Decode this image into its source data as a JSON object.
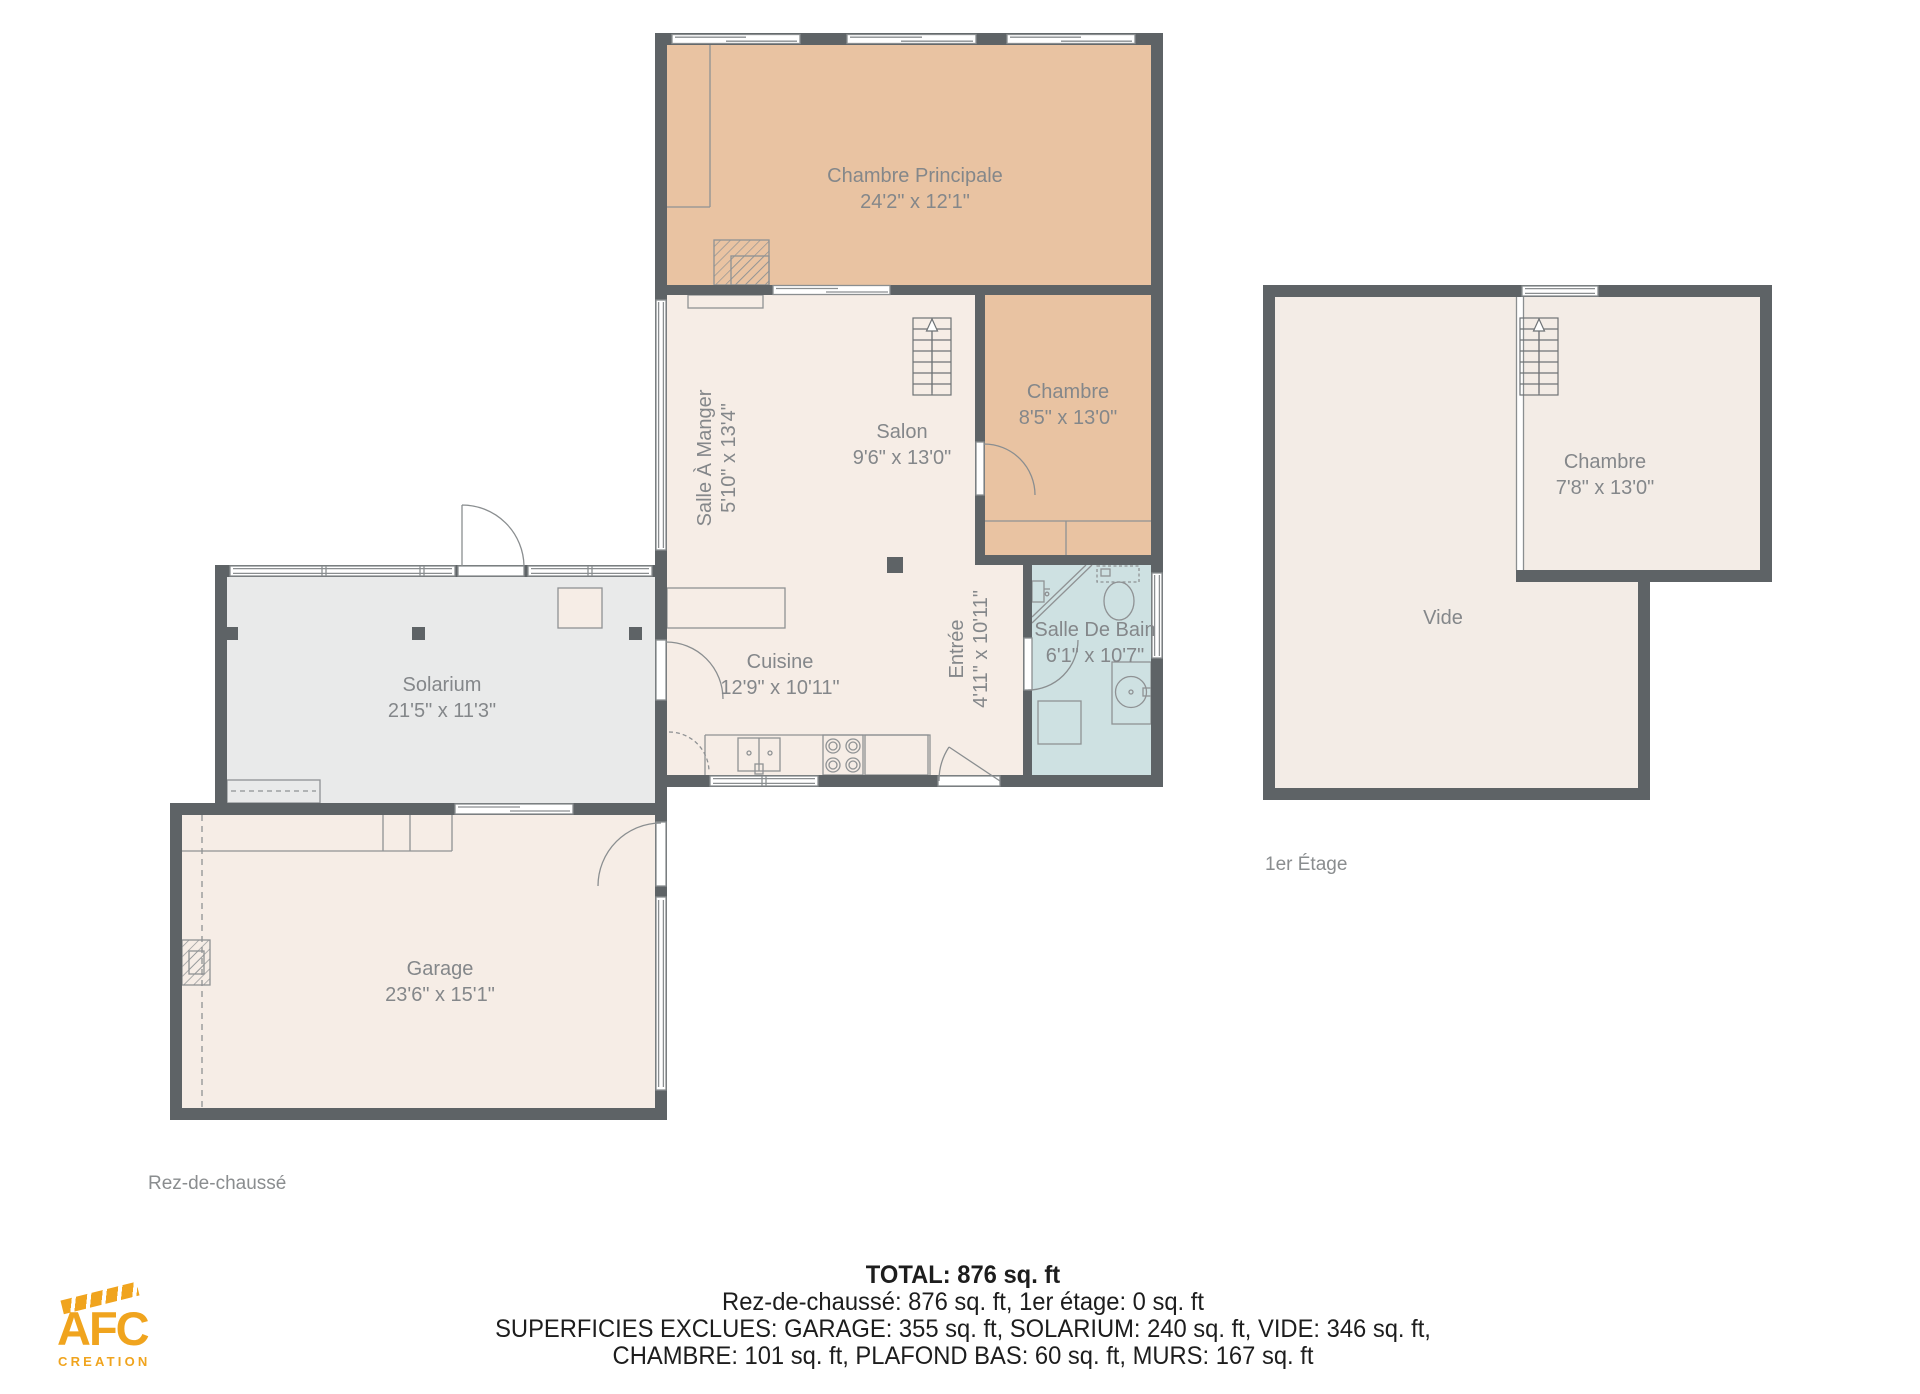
{
  "colors": {
    "wall": "#5e6366",
    "room_tan": "#e9c3a2",
    "room_cream": "#f6ede6",
    "room_cream_first": "#f3ece6",
    "room_gray": "#e9eaea",
    "room_blue": "#cee1e2",
    "line": "#8f9294",
    "label_text": "#84878a",
    "footer_text": "#1d1d1d",
    "logo_orange": "#f0a41e"
  },
  "floors": {
    "ground": {
      "label": "Rez-de-chaussé",
      "rooms": {
        "chambre_principale": {
          "name": "Chambre Principale",
          "dims": "24'2\" x 12'1\""
        },
        "salle_a_manger": {
          "name": "Salle À Manger",
          "dims": "5'10\" x 13'4\""
        },
        "salon": {
          "name": "Salon",
          "dims": "9'6\" x 13'0\""
        },
        "chambre": {
          "name": "Chambre",
          "dims": "8'5\" x 13'0\""
        },
        "entree": {
          "name": "Entrée",
          "dims": "4'11\" x 10'11\""
        },
        "salle_de_bain": {
          "name": "Salle De Bain",
          "dims": "6'1\" x 10'7\""
        },
        "cuisine": {
          "name": "Cuisine",
          "dims": "12'9\" x 10'11\""
        },
        "solarium": {
          "name": "Solarium",
          "dims": "21'5\" x 11'3\""
        },
        "garage": {
          "name": "Garage",
          "dims": "23'6\" x 15'1\""
        }
      }
    },
    "first": {
      "label": "1er Étage",
      "rooms": {
        "chambre": {
          "name": "Chambre",
          "dims": "7'8\" x 13'0\""
        },
        "vide": {
          "name": "Vide"
        }
      }
    }
  },
  "summary": {
    "total": "TOTAL: 876 sq. ft",
    "floors_line": "Rez-de-chaussé: 876 sq. ft, 1er étage: 0 sq. ft",
    "excluded_line1": "SUPERFICIES EXCLUES: GARAGE: 355 sq. ft, SOLARIUM: 240 sq. ft, VIDE: 346 sq. ft,",
    "excluded_line2": "CHAMBRE: 101 sq. ft, PLAFOND BAS: 60 sq. ft, MURS: 167 sq. ft"
  },
  "logo": {
    "title": "AFC",
    "subtitle": "CREATION"
  }
}
